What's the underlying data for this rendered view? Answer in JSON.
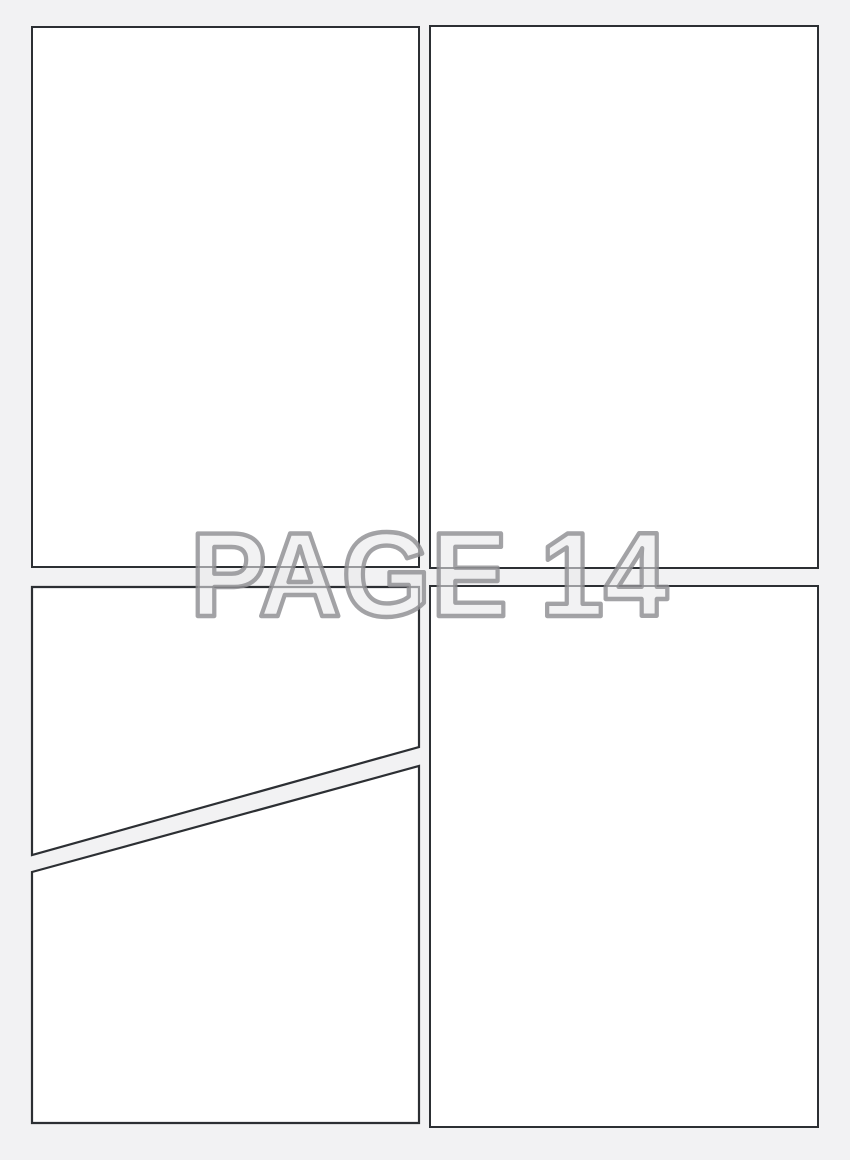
{
  "page": {
    "label": "PAGE 14",
    "number": "14"
  },
  "panels": {
    "top_left": "panel-top-left",
    "top_right": "panel-top-right",
    "bottom_left_upper": "panel-bottom-left-upper",
    "bottom_left_lower": "panel-bottom-left-lower",
    "bottom_right": "panel-bottom-right"
  },
  "colors": {
    "background": "#f2f2f3",
    "panel_fill": "#ffffff",
    "panel_border": "#2c2f33",
    "watermark_fill": "#e8e8ea",
    "watermark_outline": "#8f8f92"
  }
}
